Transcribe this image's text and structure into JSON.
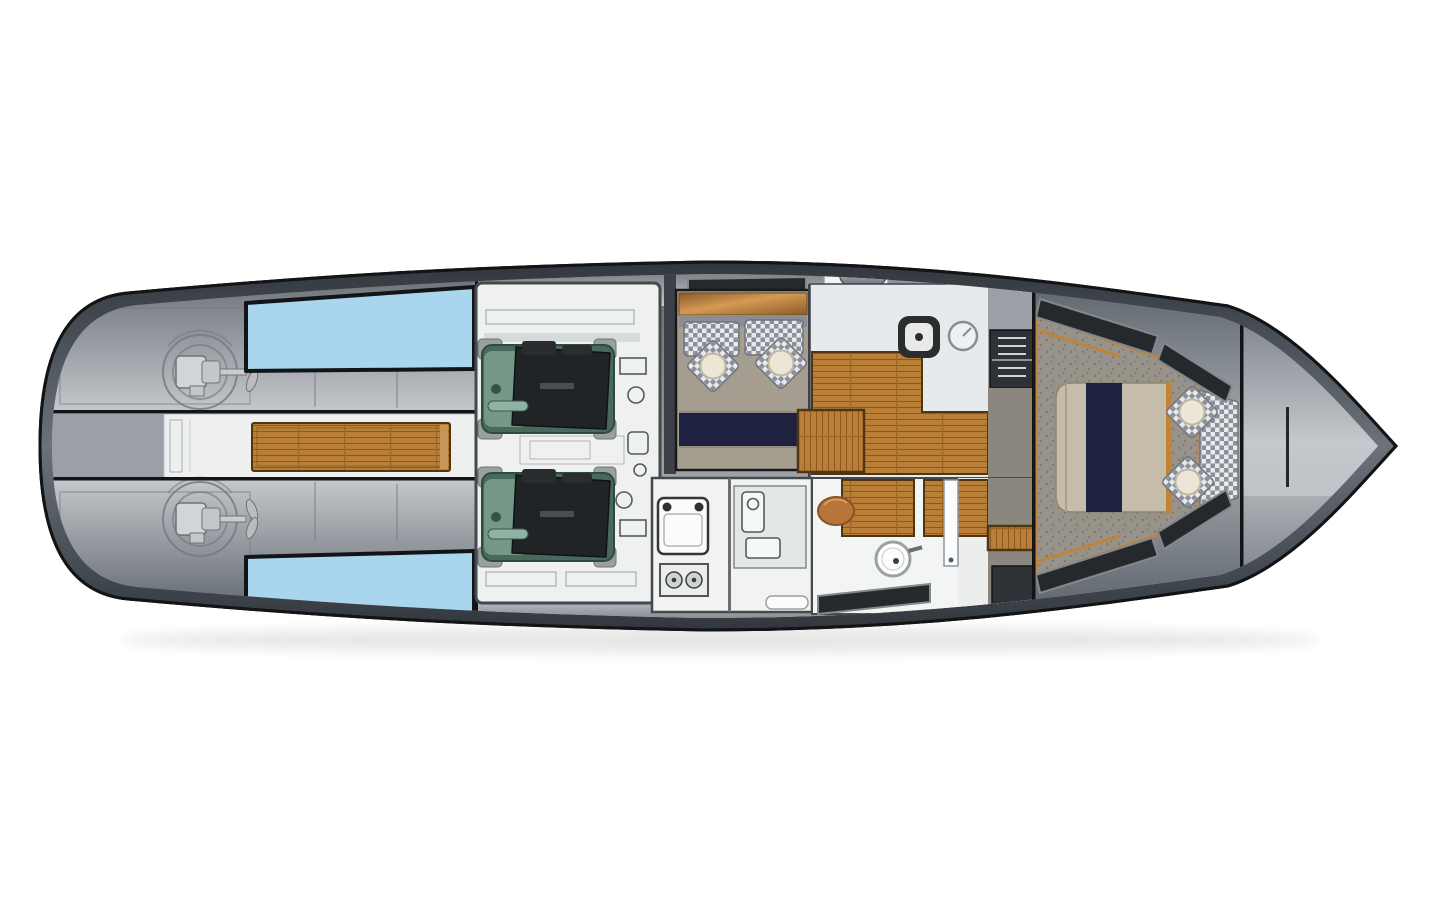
{
  "document": {
    "type": "yacht-deck-plan-top-view",
    "background": "#ffffff"
  },
  "regions": {
    "hull": "hull",
    "aft_deck": "aft-deck",
    "skylight_port": "skylight-port",
    "skylight_starboard": "skylight-starboard",
    "pod_drive_port": "pod-drive-port",
    "pod_drive_starboard": "pod-drive-starboard",
    "cockpit_plank": "teak-cockpit-plank",
    "engine_room": "engine-room",
    "engine_port": "engine-port",
    "engine_starboard": "engine-starboard",
    "dinette": "dinette",
    "galley": "galley",
    "companionway_steps": "companionway-steps",
    "utility_room": "utility-room",
    "head": "head-bathroom",
    "stairwell": "stairwell",
    "forward_cabin": "forward-cabin",
    "bed": "double-berth",
    "bow_deck": "foredeck"
  },
  "colors": {
    "page_bg": "#ffffff",
    "hull_outline": "#121416",
    "hull_band_dark": "#31373d",
    "hull_band_mid": "#6b727a",
    "deck_dark": "#646a72",
    "deck_light": "#c6c9cd",
    "deck_mid": "#9ba0a6",
    "skylight_blue": "#a9d6ee",
    "corridor_white": "#eef0f0",
    "teak": "#b97f39",
    "teak_dark": "#8a5a22",
    "teak_joint": "#9c6627",
    "teak_border": "#503511",
    "teak_cap": "#c89559",
    "engine_room_floor": "#eff1f0",
    "room_stroke": "#45484c",
    "engine_teal": "#49695d",
    "engine_teal_light": "#7ba08d",
    "engine_black": "#212426",
    "machinery_gray": "#9aa09f",
    "sketch_gray": "#74787e",
    "dinette_wall": "#3d4147",
    "sideboard_wood_light": "#d49a55",
    "sideboard_wood_dark": "#8a5a26",
    "bench_tan": "#a59d90",
    "backrest_gray": "#8a8d92",
    "navy": "#1e2240",
    "checker_light": "#e8e9ea",
    "checker_dark": "#8b909a",
    "cream": "#ece6d6",
    "marble": "#e7eaec",
    "head_white": "#f3f4f4",
    "utility_white": "#f1f2f1",
    "sink_dark": "#2b2d2f",
    "carpet": "#97938a",
    "carpet_speckle": "#7e7a70",
    "bed_tan": "#c6bcaa",
    "window_dark": "#26292c",
    "window_frame": "#83888d",
    "wood_trim": "#c08338",
    "stair_panel": "#2e3135",
    "stair_rung": "#d0d4d8",
    "landing_gray": "#8b867e",
    "fixture_stroke": "#565a5e",
    "basin_white": "#fdfdfd",
    "stool_wood": "#b9743a",
    "metal": "#9aa0a5"
  }
}
